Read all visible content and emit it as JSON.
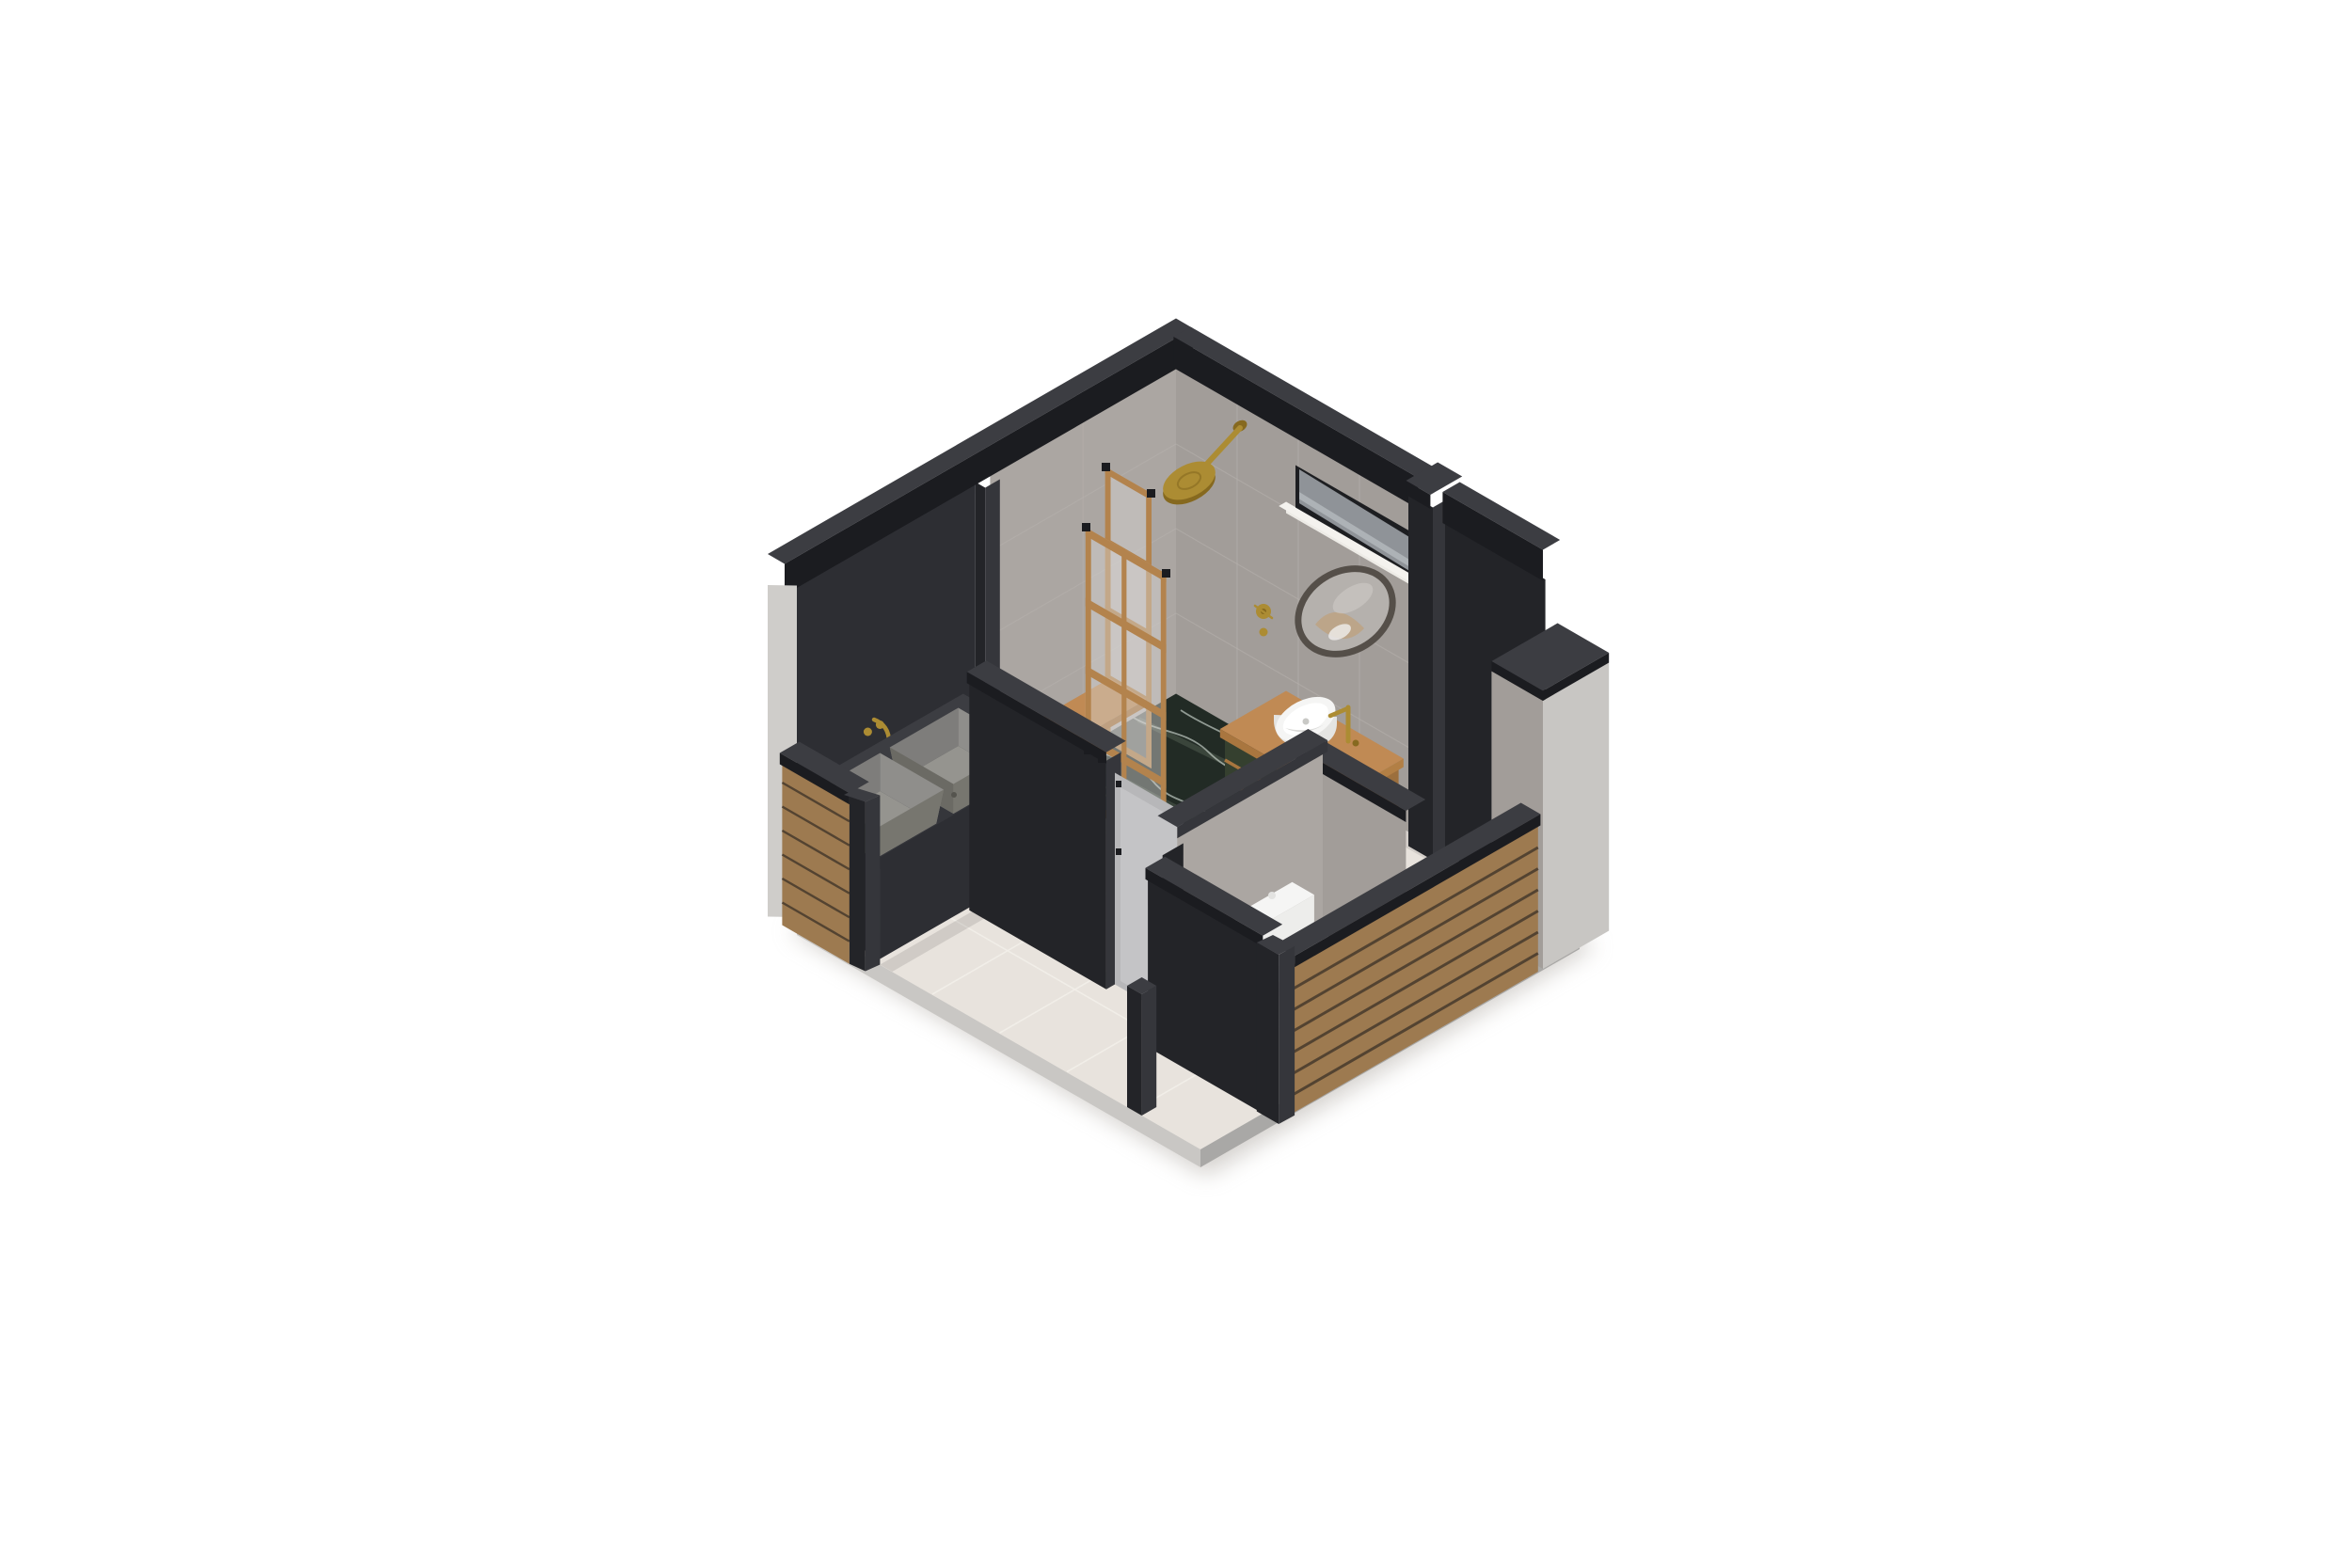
{
  "meta": {
    "description": "Isometric cutaway 3D render of a bathroom floor plan on a white background",
    "projection": "isometric",
    "background": "#ffffff"
  },
  "palette": {
    "bg": "#ffffff",
    "shadow": "#aaa49d",
    "floorTile": "#e8e3dd",
    "floorGrout": "#f2eee9",
    "plinthSW": "#c9c7c4",
    "plinthSE": "#a9a8a6",
    "darkTop": "#3c3d42",
    "darkSE": "#2d2e33",
    "darkSE2": "#35363b",
    "darkSW": "#232428",
    "darkest": "#1b1c20",
    "tileSE": "#aba6a2",
    "tileSW": "#a29d99",
    "grout": "#b6b1ad",
    "lightEnd": "#cfcdca",
    "grayFace": "#c8c6c3",
    "wood": "#c08a54",
    "woodMid": "#a9763f",
    "woodDark": "#8d6234",
    "woodFrame": "#b3834d",
    "slat": "#9d7a50",
    "slatGap": "#46392b",
    "marble": "#222b25",
    "marbleEdge": "#1a211c",
    "marbleEdge2": "#273029",
    "vein": "#ccd5ce",
    "veinSoft": "#74816f",
    "greenCab": "#35402f",
    "brass": "#ac8c33",
    "brassDark": "#86691f",
    "white": "#f5f5f4",
    "whiteShade": "#e4e4e2",
    "whiteShade2": "#ededeb",
    "doorGray": "#b7b7b9",
    "doorGrayIn": "#c4c4c6",
    "glass": "#d7d5d2",
    "mirrorFrame": "#554f49",
    "mirrorGlass": "#b5b1ad",
    "windowDark": "#1d1e21",
    "windowGlass": "#8f9398",
    "windowStreak": "#c2c6c9",
    "sill": "#edebe6",
    "sillTop": "#f4f2ee",
    "skirt": "#efece7",
    "basinIn1": "#8f8e8b",
    "basinIn2": "#7e7d7b",
    "basinFloor": "#95948f",
    "chrome": "#9aa0a4"
  },
  "scene": {
    "objects": [
      {
        "id": "floor",
        "label": "beige tiled floor slab"
      },
      {
        "id": "wall-back-left",
        "label": "tall wall, charcoal and gray tile faces"
      },
      {
        "id": "wall-back-right",
        "label": "tall wall with clerestory window band"
      },
      {
        "id": "shower",
        "label": "corner shower with green marble floor"
      },
      {
        "id": "shower-head",
        "label": "brass rain shower on arm"
      },
      {
        "id": "shower-screen-wide",
        "label": "wood framed glass screen, 2x4 panes"
      },
      {
        "id": "shower-screen-narrow",
        "label": "wood framed glass screen, 1x4 panes"
      },
      {
        "id": "shower-bench",
        "label": "floating wood bench"
      },
      {
        "id": "double-sink-counter",
        "label": "dark counter with two gray trough basins"
      },
      {
        "id": "wall-faucet",
        "label": "brass wall mounted mixer"
      },
      {
        "id": "vanity",
        "label": "wall hung vanity, wood top, green drawers"
      },
      {
        "id": "vessel-sink",
        "label": "white oval vessel basin with brass tap"
      },
      {
        "id": "mirror",
        "label": "round mirror, dark frame"
      },
      {
        "id": "entry-partition",
        "label": "charcoal partition stub wall"
      },
      {
        "id": "entry-door",
        "label": "gray door leaf with hinges"
      },
      {
        "id": "door-post",
        "label": "freestanding charcoal post"
      },
      {
        "id": "wc-room",
        "label": "water closet with cut charcoal walls"
      },
      {
        "id": "toilet",
        "label": "white toilet with cistern"
      },
      {
        "id": "small-basin",
        "label": "small white rinse basin with tap"
      },
      {
        "id": "slat-wall-right",
        "label": "low wood slat wall, front right"
      },
      {
        "id": "slat-wall-left",
        "label": "low wood slat wall, front left"
      },
      {
        "id": "corner-column",
        "label": "corner column, light gray face"
      }
    ]
  }
}
